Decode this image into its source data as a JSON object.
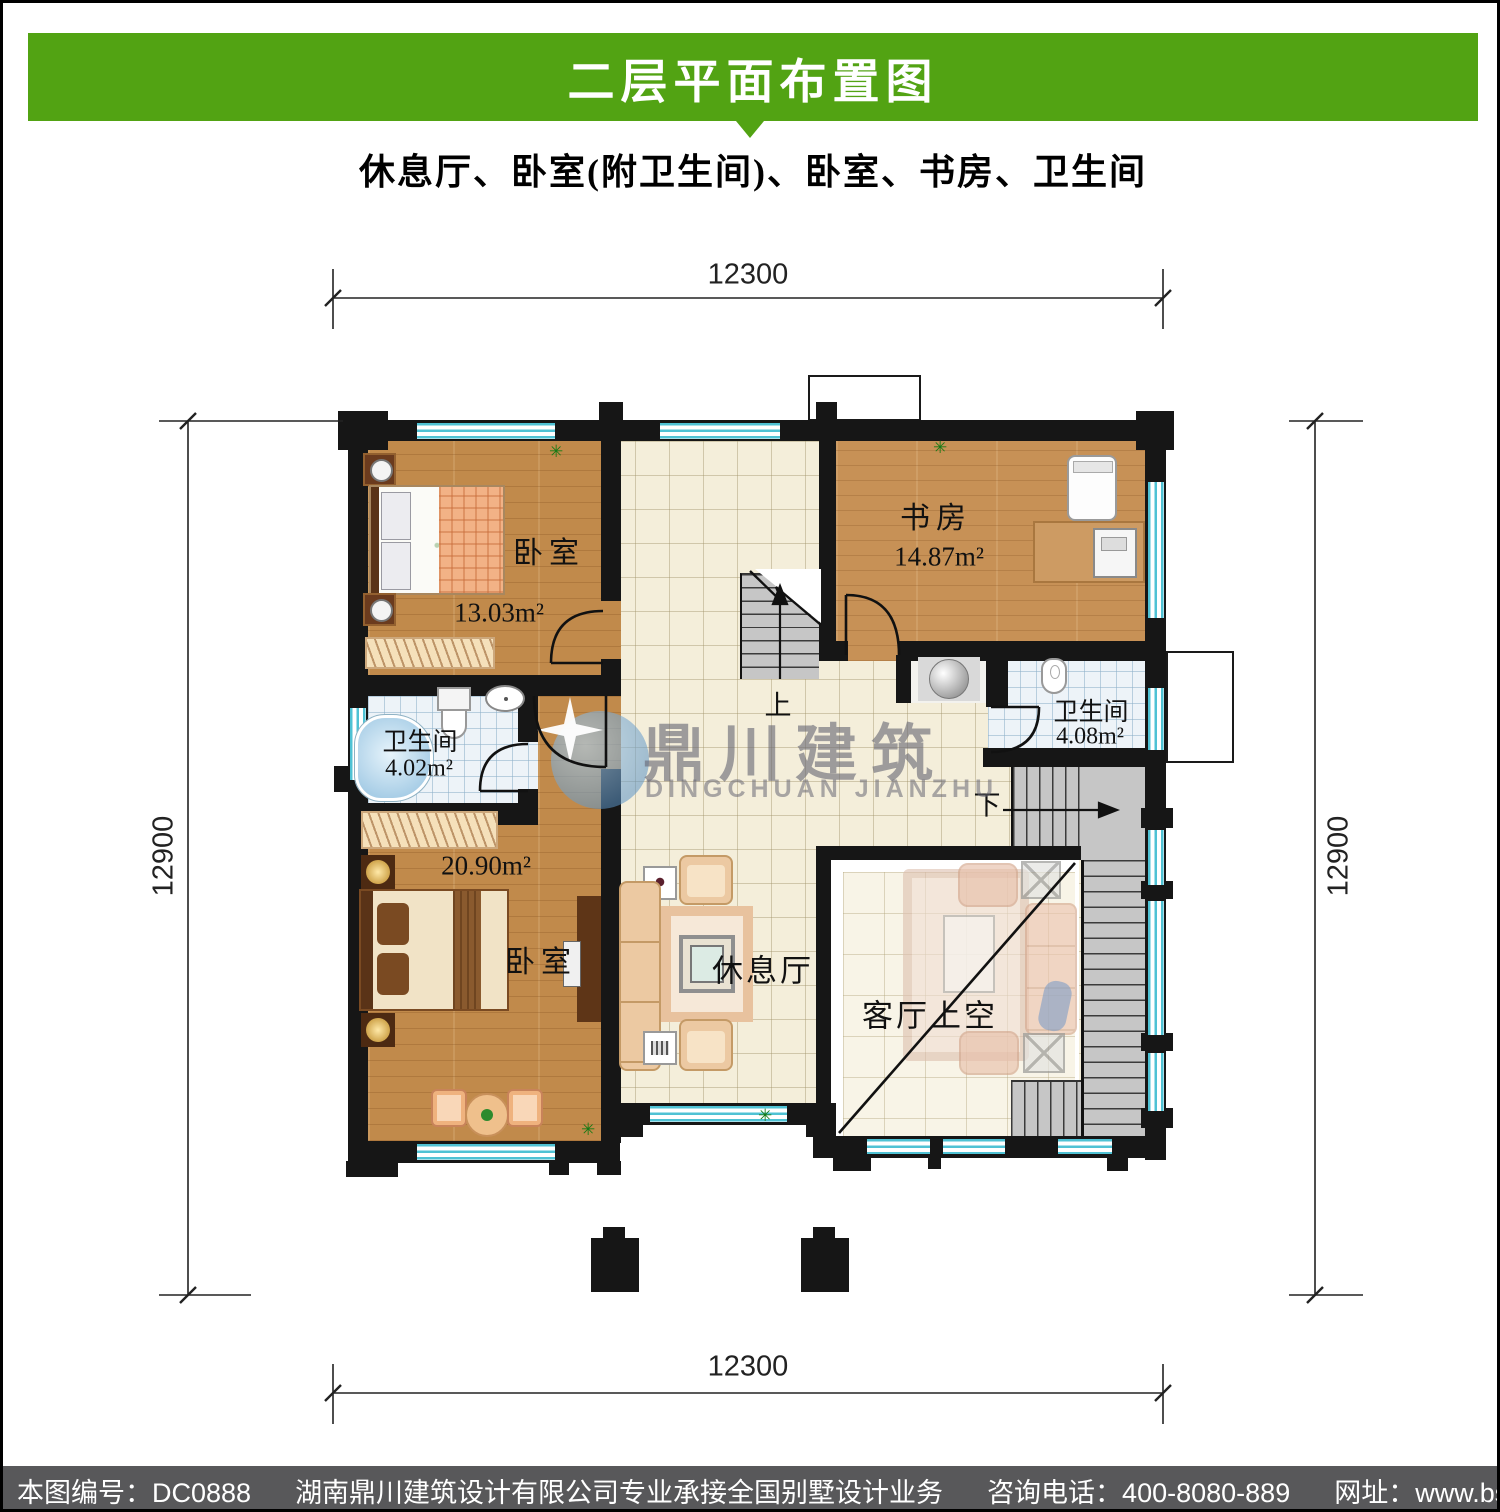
{
  "header": {
    "title": "二层平面布置图",
    "subtitle": "休息厅、卧室(附卫生间)、卧室、书房、卫生间"
  },
  "plan": {
    "dimensions": {
      "top": "12300",
      "bottom": "12300",
      "left": "12900",
      "right": "12900"
    },
    "rooms": {
      "bedroom_top": {
        "name": "卧室",
        "area": "13.03m²"
      },
      "bedroom_bottom": {
        "name": "卧室",
        "area": "20.90m²"
      },
      "study": {
        "name": "书房",
        "area": "14.87m²"
      },
      "bath_left": {
        "name": "卫生间",
        "area": "4.02m²"
      },
      "bath_right": {
        "name": "卫生间",
        "area": "4.08m²"
      },
      "lounge": {
        "name": "休息厅"
      },
      "void": {
        "name": "客厅上空"
      }
    },
    "stairs": {
      "up": "上",
      "down": "下"
    }
  },
  "watermark": {
    "cn": "鼎川建筑",
    "en": "DINGCHUAN JIANZHU"
  },
  "footer": {
    "code": "本图编号：DC0888",
    "company": "湖南鼎川建筑设计有限公司专业承接全国别墅设计业务",
    "phone": "咨询电话：400-8080-889",
    "website": "网址：www.bstzcs.com"
  },
  "colors": {
    "banner_green": "#52a313",
    "footer_gray": "#58585a",
    "wall_black": "#161616",
    "wood_floor": "#c18a4b",
    "hall_tile": "#f4eeda",
    "bath_tile": "#edf3f8",
    "stair_gray": "#c6c6c6",
    "window_cyan": "#4fc2d4"
  }
}
